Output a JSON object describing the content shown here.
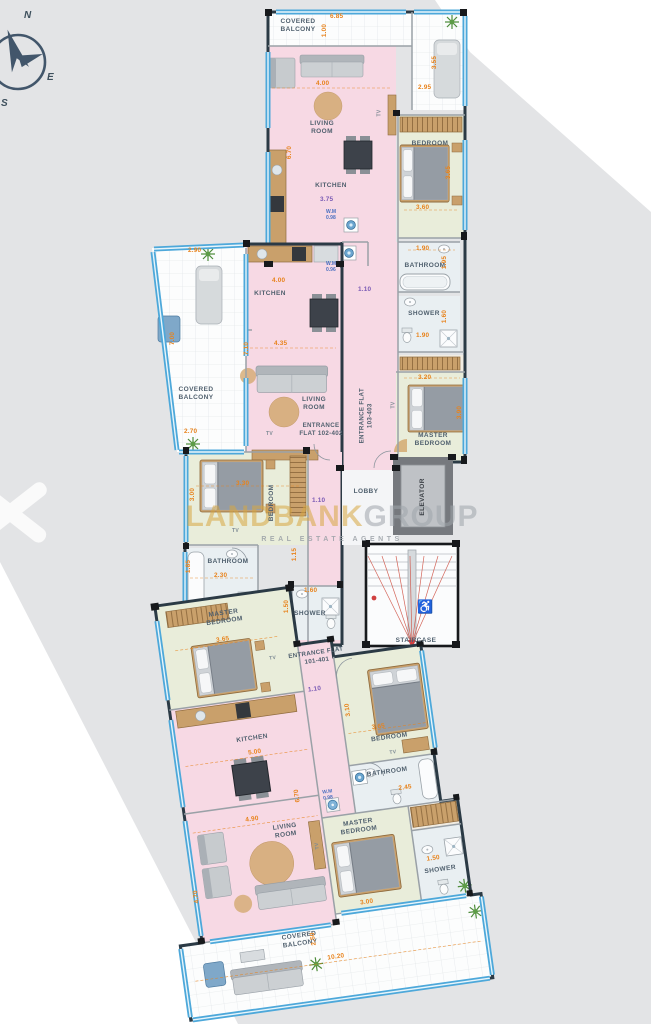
{
  "compass": {
    "n": "N",
    "e": "E",
    "s": "S"
  },
  "watermark": {
    "gold": "LANDBANK",
    "gray": "GROUP",
    "tagline": "REAL ESTATE AGENTS"
  },
  "core": {
    "lobby": "LOBBY",
    "elevator": "ELEVATOR",
    "staircase": "STAIRCASE",
    "accessible_icon": "♿"
  },
  "f103": {
    "entrance": "ENTRANCE FLAT 103-403",
    "hall_w": "1.10",
    "balcony": {
      "name": "COVERED BALCONY",
      "w": "6.85",
      "d": "1.00"
    },
    "terrace": {
      "w": "2.95",
      "d": "3.55"
    },
    "living": {
      "name": "LIVING ROOM",
      "w": "4.00",
      "d": "6.70"
    },
    "kitchen": {
      "name": "KITCHEN",
      "w": "3.75"
    },
    "wm1": {
      "label": "W.M",
      "v": "0.98"
    },
    "wm2": {
      "label": "W.M",
      "v": "0.96"
    },
    "bedroom": {
      "name": "BEDROOM",
      "w": "3.60",
      "d": "3.65"
    },
    "bath": {
      "name": "BATHROOM",
      "w": "1.90",
      "d": "1.95"
    },
    "shower": {
      "name": "SHOWER",
      "w": "1.90",
      "d": "1.60"
    },
    "master": {
      "name": "MASTER BEDROOM",
      "w": "3.20",
      "d": "3.90"
    },
    "tv": "TV"
  },
  "f102": {
    "entrance": "ENTRANCE FLAT 102-402",
    "balcony": {
      "name": "COVERED BALCONY",
      "w_top": "2.90",
      "d": "7.00",
      "w_bot": "2.70"
    },
    "kitchen": {
      "name": "KITCHEN",
      "w": "4.00"
    },
    "living": {
      "name": "LIVING ROOM",
      "w": "4.35",
      "d": "7.10"
    },
    "bedroom": {
      "name": "BEDROOM",
      "w": "3.30",
      "d": "3.00"
    },
    "hall": {
      "w": "1.10",
      "d": "1.15"
    },
    "bath": {
      "name": "BATHROOM",
      "w": "2.30",
      "d": "1.85"
    },
    "shower": {
      "name": "SHOWER",
      "w": "1.60",
      "d": "1.50"
    },
    "tv": "TV"
  },
  "f101": {
    "entrance": "ENTRANCE FLAT 101-401",
    "hall_w": "1.10",
    "master_left": {
      "name": "MASTER BEDROOM",
      "w": "3.65"
    },
    "kitchen": {
      "name": "KITCHEN",
      "w": "5.00"
    },
    "wm": {
      "label": "W.M",
      "v": "0.98"
    },
    "living": {
      "name": "LIVING ROOM",
      "w": "4.90",
      "d": "6.70"
    },
    "master_right": {
      "name": "MASTER BEDROOM",
      "w": "3.00"
    },
    "bedroom": {
      "name": "BEDROOM",
      "w": "3.65",
      "d": "3.10"
    },
    "bath": {
      "name": "BATHROOM",
      "w": "2.45"
    },
    "shower": {
      "name": "SHOWER",
      "w": "1.50"
    },
    "balcony": {
      "name": "COVERED BALCONY",
      "w": "10.20",
      "d": "2.50",
      "side": "4.70"
    },
    "tv": "TV"
  }
}
